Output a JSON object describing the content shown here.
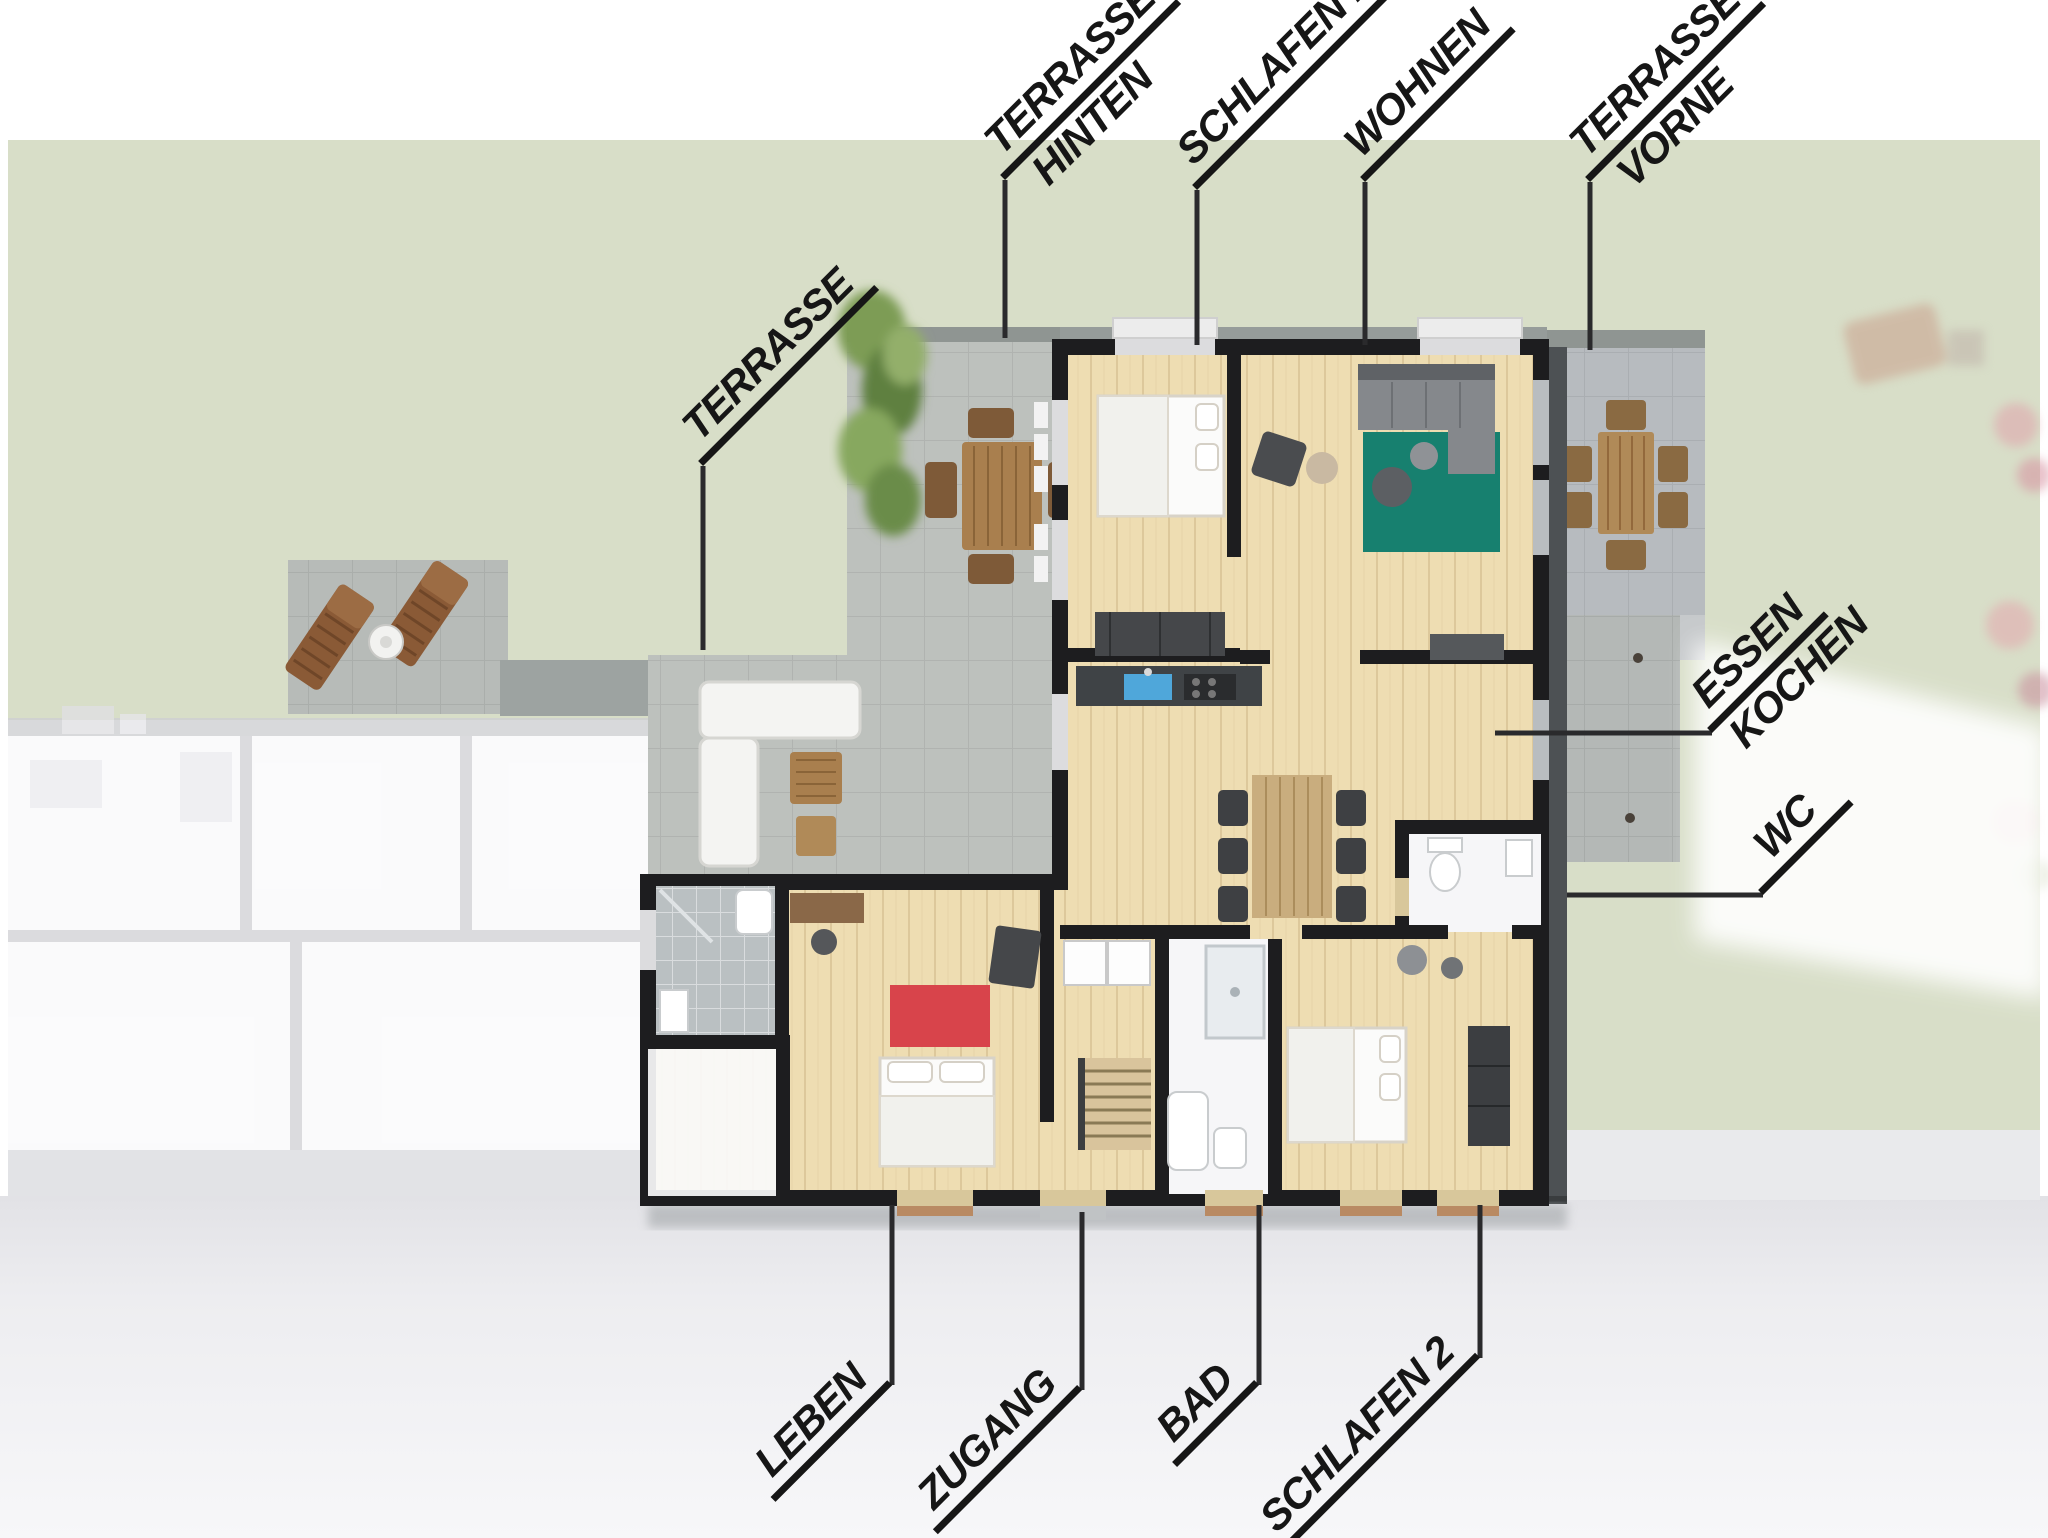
{
  "scene": {
    "type": "apartment-floor-plan-3d-render",
    "width_px": 2048,
    "height_px": 1538
  },
  "labels": {
    "terrasse_hinten": {
      "line1": "TERRASSE",
      "line2": "HINTEN"
    },
    "schlafen_1": {
      "line1": "SCHLAFEN 1"
    },
    "wohnen": {
      "line1": "WOHNEN"
    },
    "terrasse_vorne": {
      "line1": "TERRASSE",
      "line2": "VORNE"
    },
    "terrasse": {
      "line1": "TERRASSE"
    },
    "essen_kochen": {
      "line1": "ESSEN",
      "line2": "KOCHEN"
    },
    "wc": {
      "line1": "WC"
    },
    "leben": {
      "line1": "LEBEN"
    },
    "zugang": {
      "line1": "ZUGANG"
    },
    "bad": {
      "line1": "BAD"
    },
    "schlafen_2": {
      "line1": "SCHLAFEN 2"
    }
  },
  "colors": {
    "background": "#ffffff",
    "garden": "#d8dec8",
    "driveway": "#ebebee",
    "terrace": "#bdc1bd",
    "terrace_front": "#b7bbbf",
    "walkway": "#9da3a1",
    "wall": "#1d1d1f",
    "wood_floor": "#eeddb2",
    "rug_teal": "#17806f",
    "rug_red": "#d8444b",
    "sink_blue": "#4fa7da",
    "leader": "#2a2a2c",
    "label_text": "#161616",
    "neighbor_wall": "#cfd0d3",
    "white_room": "#f6f6f8"
  }
}
